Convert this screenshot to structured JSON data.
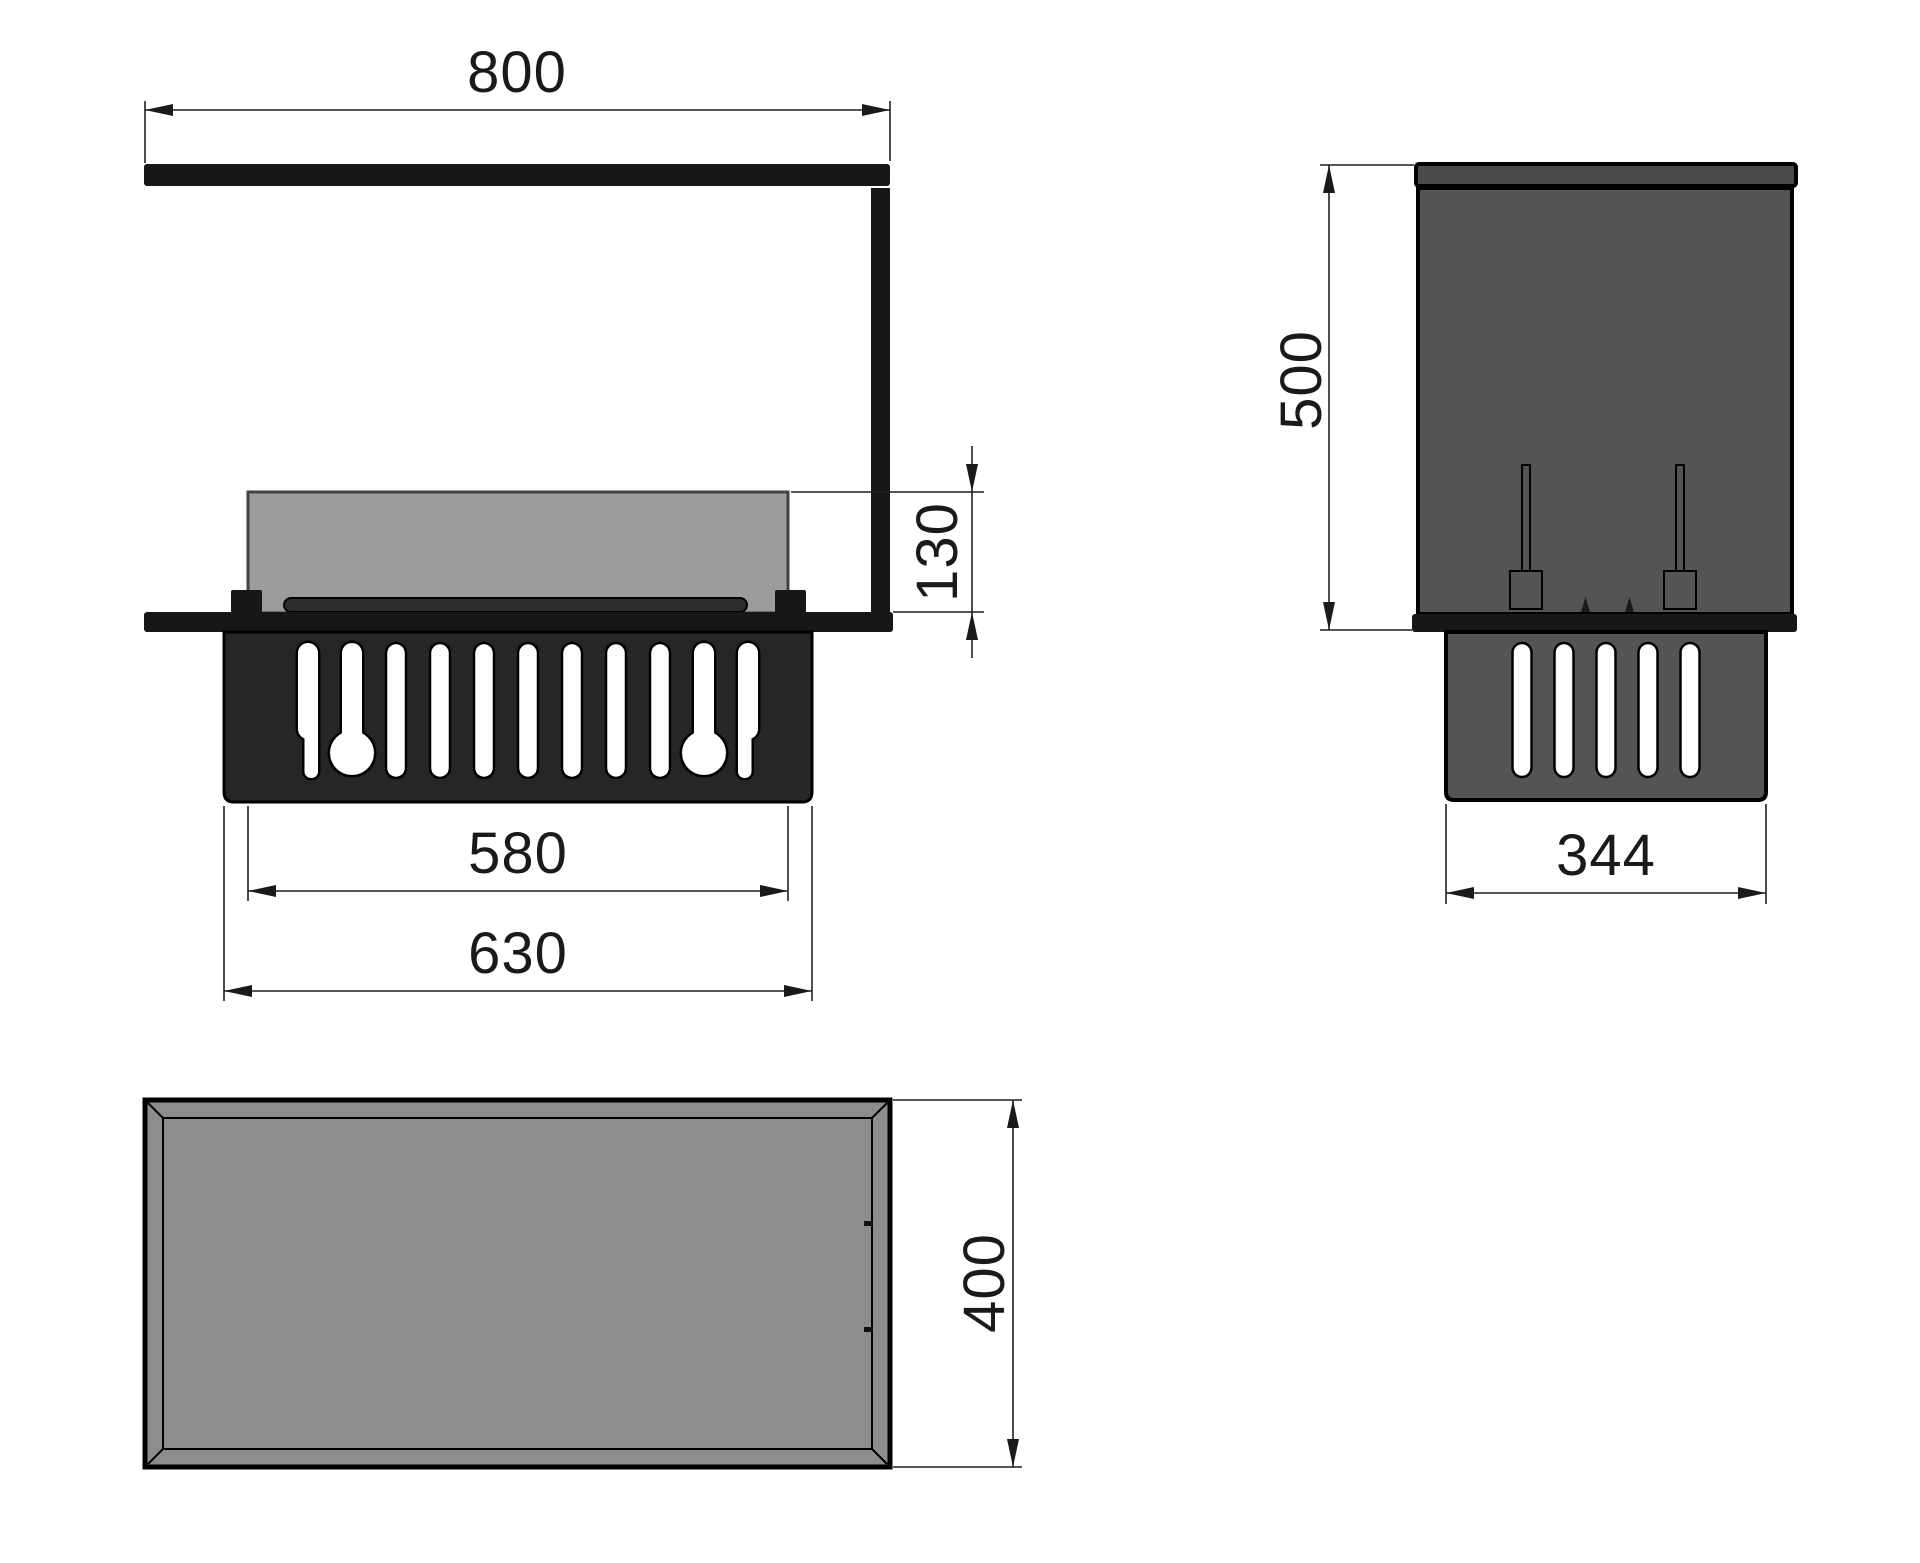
{
  "views": {
    "front": {
      "dimensions": {
        "overall_width": "800",
        "glass_height": "130",
        "burner_inner_width": "580",
        "burner_box_width": "630"
      }
    },
    "side": {
      "dimensions": {
        "overall_height": "500",
        "burner_box_depth": "344"
      }
    },
    "top": {
      "dimensions": {
        "overall_depth": "400"
      }
    }
  },
  "colors": {
    "line": "#1f1f1f",
    "text": "#1a1a1a",
    "metal": "#171717",
    "box_front": "#262626",
    "side_body": "#545454",
    "side_topbar": "#4a4a4a",
    "glass": "#9c9c9c",
    "tray": "#2d2d2d",
    "top_face": "#8d8d8d",
    "slot": "#ffffff"
  }
}
